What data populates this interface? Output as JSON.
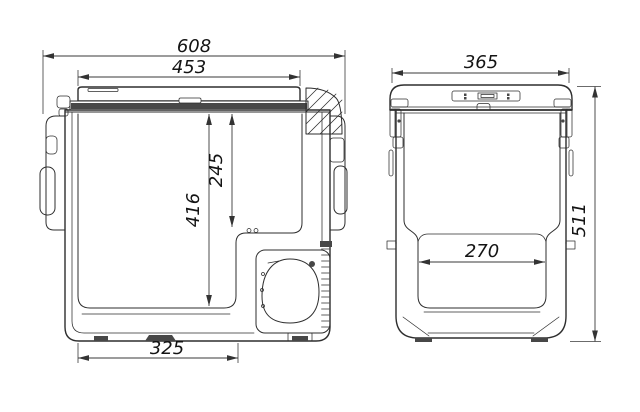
{
  "front_view": {
    "dims": {
      "overall_width": "608",
      "lid_width": "453",
      "inner_depth_upper": "245",
      "inner_depth_full": "416",
      "base_width": "325"
    }
  },
  "side_view": {
    "dims": {
      "overall_depth": "365",
      "inner_width": "270",
      "overall_height": "511"
    }
  },
  "colors": {
    "line": "#2e2e2e",
    "dim_line": "#3a3a3a",
    "text": "#141414",
    "background": "#ffffff",
    "dark_fill": "#474747"
  }
}
